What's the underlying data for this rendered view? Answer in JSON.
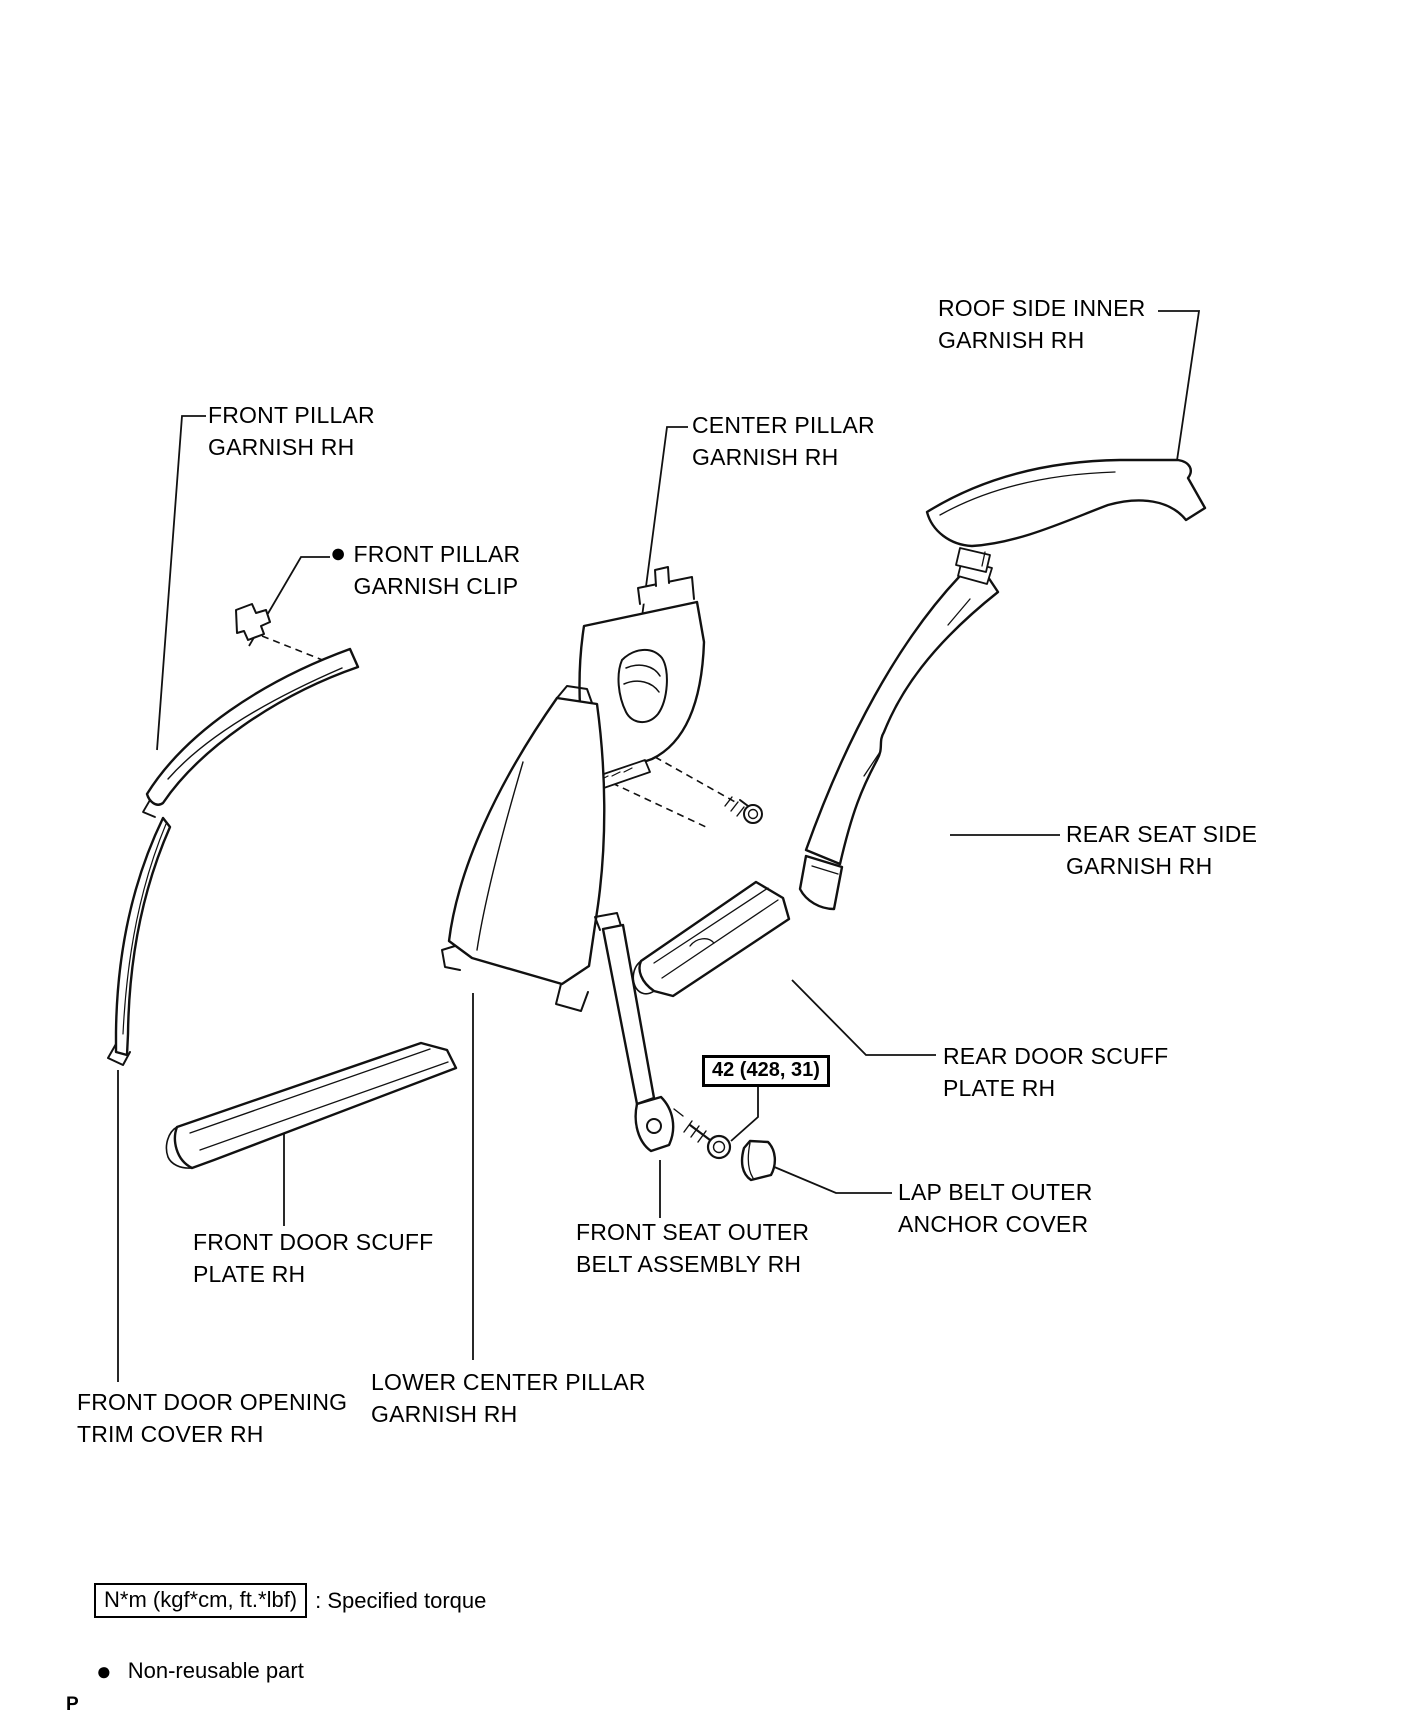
{
  "labels": {
    "roof_side_inner": {
      "line1": "ROOF SIDE INNER",
      "line2": "GARNISH RH"
    },
    "front_pillar_garnish": {
      "line1": "FRONT PILLAR",
      "line2": "GARNISH RH"
    },
    "front_pillar_clip": {
      "bullet": "●",
      "line1": "FRONT PILLAR",
      "line2": "GARNISH CLIP"
    },
    "center_pillar_garnish": {
      "line1": "CENTER PILLAR",
      "line2": "GARNISH RH"
    },
    "rear_seat_side": {
      "line1": "REAR SEAT SIDE",
      "line2": "GARNISH RH"
    },
    "rear_door_scuff": {
      "line1": "REAR DOOR SCUFF",
      "line2": "PLATE RH"
    },
    "lap_belt_cover": {
      "line1": "LAP BELT OUTER",
      "line2": "ANCHOR COVER"
    },
    "front_seat_belt": {
      "line1": "FRONT SEAT OUTER",
      "line2": "BELT ASSEMBLY RH"
    },
    "front_door_scuff": {
      "line1": "FRONT DOOR SCUFF",
      "line2": "PLATE RH"
    },
    "lower_center_pillar": {
      "line1": "LOWER CENTER PILLAR",
      "line2": "GARNISH RH"
    },
    "front_door_opening": {
      "line1": "FRONT DOOR OPENING",
      "line2": "TRIM COVER RH"
    }
  },
  "torque_callout": {
    "value": "42 (428, 31)"
  },
  "legend": {
    "torque_box": "N*m (kgf*cm, ft.*lbf)",
    "torque_desc": ": Specified torque",
    "bullet": "●",
    "non_reusable": "Non-reusable part"
  },
  "page_marker": "P",
  "colors": {
    "line": "#111111",
    "background": "#ffffff"
  }
}
